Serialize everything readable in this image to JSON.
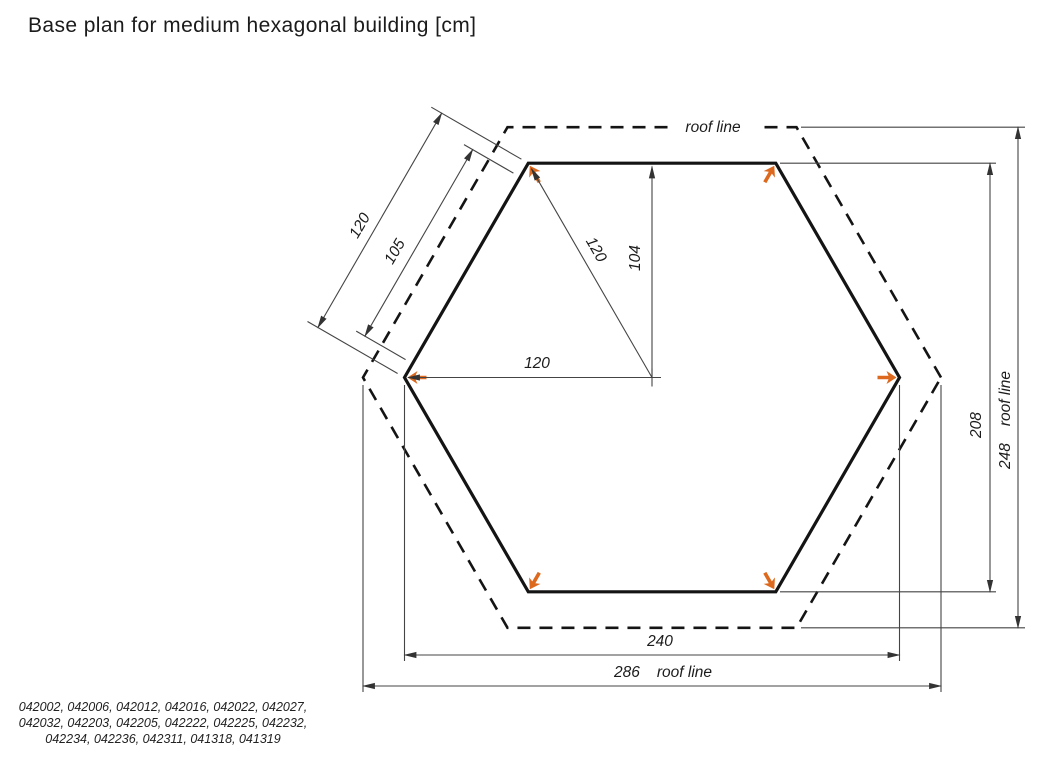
{
  "title": "Base plan for medium hexagonal building [cm]",
  "labels": {
    "roof_line": "roof line"
  },
  "dimensions": {
    "roof_edge": "120",
    "wall_edge": "105",
    "center_to_corner": "120",
    "center_to_wall": "104",
    "center_to_left_corner": "120",
    "building_width": "240",
    "roof_width": "286",
    "building_height": "208",
    "roof_height": "248"
  },
  "product_codes": {
    "lines": [
      "042002,  042006,  042012,  042016,  042022,  042027,",
      "042032,  042203,  042205,  042222,  042225,  042232,",
      "042234,  042236,  042311,  041318,  041319"
    ]
  },
  "colors": {
    "marker": "#dc691e",
    "line": "#141414",
    "dim_line": "#444444"
  }
}
